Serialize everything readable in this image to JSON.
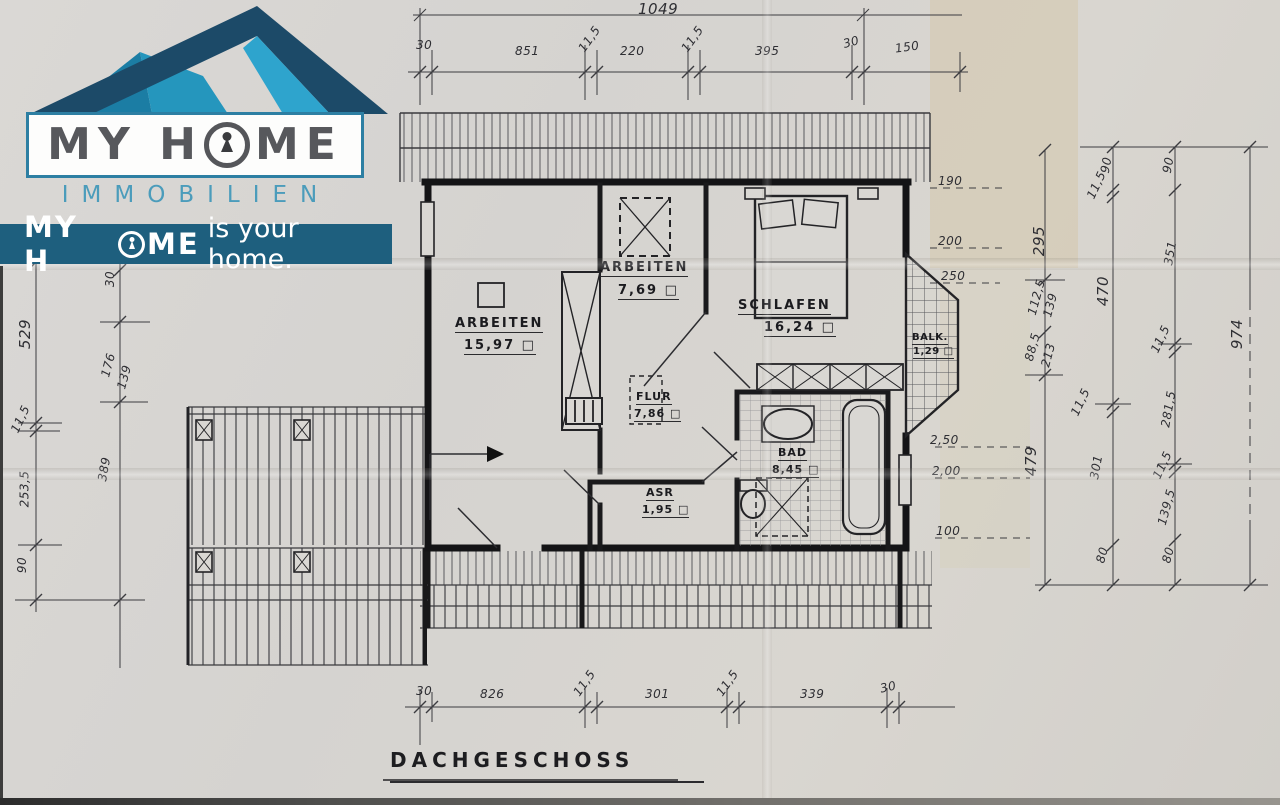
{
  "logo": {
    "title_pre": "MY H",
    "title_post": "ME",
    "subtitle": "IMMOBILIEN",
    "tagline_pre": "MY H",
    "tagline_post": "ME",
    "tagline_rest": "is your home.",
    "colors": {
      "roof_navy": "#1c4a68",
      "roof_teal": "#1b7da4",
      "roof_cyan": "#2ea4cd",
      "banner": "#1e5f7e",
      "title_gray": "#57585c",
      "subtitle_teal": "#4b9cbb"
    }
  },
  "plan": {
    "title": "DACHGESCHOSS",
    "rooms": [
      {
        "name": "ARBEITEN",
        "area": "15,97 □"
      },
      {
        "name": "ARBEITEN",
        "area": "7,69 □"
      },
      {
        "name": "SCHLAFEN",
        "area": "16,24 □"
      },
      {
        "name": "FLUR",
        "area": "7,86 □"
      },
      {
        "name": "BAD",
        "area": "8,45 □"
      },
      {
        "name": "ASR",
        "area": "1,95 □"
      },
      {
        "name": "BALK.",
        "area": "1,29 □"
      }
    ],
    "dims": {
      "top_total": "1049",
      "top": [
        "30",
        "851",
        "11,5",
        "220",
        "11,5",
        "395",
        "30",
        "150"
      ],
      "bottom": [
        "30",
        "826",
        "11,5",
        "301",
        "11,5",
        "339",
        "30"
      ],
      "left_outer": [
        "529",
        "11,5",
        "253,5",
        "90"
      ],
      "left_inner": [
        "30",
        "176",
        "139",
        "389"
      ],
      "right_a": [
        "295",
        "112,5",
        "139",
        "88,5",
        "213",
        "479"
      ],
      "right_b": [
        "90",
        "11,5",
        "470",
        "11,5",
        "301",
        "80"
      ],
      "right_c": [
        "90",
        "351",
        "11,5",
        "281,5",
        "11,5",
        "139,5",
        "80"
      ],
      "right_total": "974"
    },
    "heights_upper": [
      "190",
      "200",
      "250"
    ],
    "heights_lower": [
      "2,50",
      "2,00",
      "100"
    ]
  }
}
